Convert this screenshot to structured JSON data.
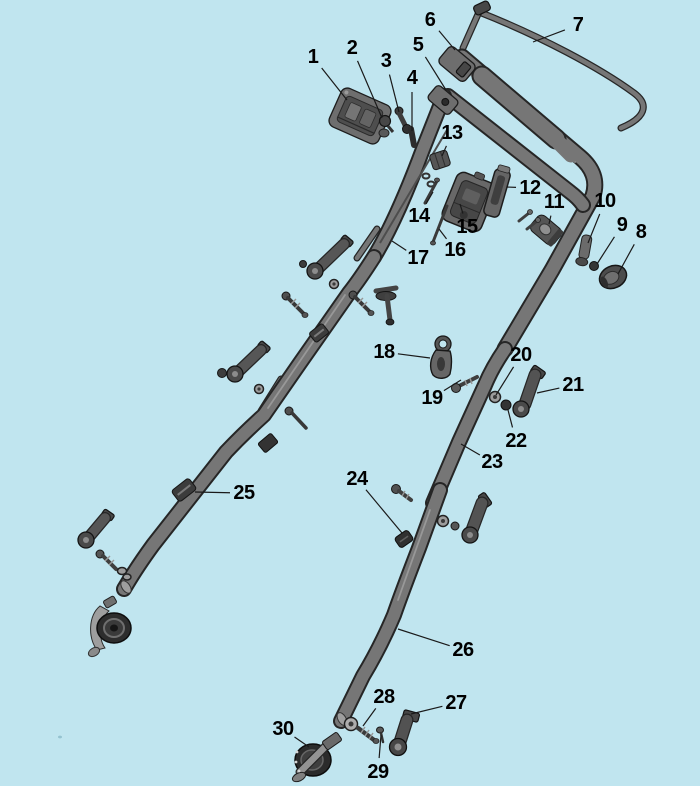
{
  "diagram": {
    "type": "exploded-parts-diagram",
    "subject": "mower-handle-assembly",
    "background_color": "#c0e5ef",
    "palette": {
      "part_dark": "#474747",
      "part_mid": "#6e6e6e",
      "part_light": "#b3b3b3",
      "outline": "#262626",
      "label_color": "#000000",
      "leader_color": "#1a1a1a"
    },
    "callouts": [
      {
        "number": "1",
        "label_x": 313,
        "label_y": 57,
        "target_x": 347,
        "target_y": 100
      },
      {
        "number": "2",
        "label_x": 352,
        "label_y": 48,
        "target_x": 382,
        "target_y": 118
      },
      {
        "number": "3",
        "label_x": 386,
        "label_y": 61,
        "target_x": 399,
        "target_y": 112
      },
      {
        "number": "4",
        "label_x": 412,
        "label_y": 78,
        "target_x": 412,
        "target_y": 131
      },
      {
        "number": "5",
        "label_x": 418,
        "label_y": 45,
        "target_x": 446,
        "target_y": 90
      },
      {
        "number": "6",
        "label_x": 430,
        "label_y": 20,
        "target_x": 455,
        "target_y": 50
      },
      {
        "number": "7",
        "label_x": 578,
        "label_y": 25,
        "target_x": 533,
        "target_y": 42
      },
      {
        "number": "8",
        "label_x": 641,
        "label_y": 232,
        "target_x": 618,
        "target_y": 274
      },
      {
        "number": "9",
        "label_x": 622,
        "label_y": 225,
        "target_x": 597,
        "target_y": 264
      },
      {
        "number": "10",
        "label_x": 605,
        "label_y": 201,
        "target_x": 588,
        "target_y": 243
      },
      {
        "number": "11",
        "label_x": 554,
        "label_y": 202,
        "target_x": 549,
        "target_y": 224
      },
      {
        "number": "12",
        "label_x": 530,
        "label_y": 188,
        "target_x": 507,
        "target_y": 187
      },
      {
        "number": "13",
        "label_x": 452,
        "label_y": 133,
        "target_x": 442,
        "target_y": 156
      },
      {
        "number": "14",
        "label_x": 419,
        "label_y": 216,
        "target_x": 433,
        "target_y": 192
      },
      {
        "number": "15",
        "label_x": 467,
        "label_y": 227,
        "target_x": 460,
        "target_y": 204
      },
      {
        "number": "16",
        "label_x": 455,
        "label_y": 250,
        "target_x": 439,
        "target_y": 229
      },
      {
        "number": "17",
        "label_x": 418,
        "label_y": 258,
        "target_x": 392,
        "target_y": 241
      },
      {
        "number": "18",
        "label_x": 384,
        "label_y": 352,
        "target_x": 430,
        "target_y": 358
      },
      {
        "number": "19",
        "label_x": 432,
        "label_y": 398,
        "target_x": 461,
        "target_y": 380
      },
      {
        "number": "20",
        "label_x": 521,
        "label_y": 355,
        "target_x": 496,
        "target_y": 395
      },
      {
        "number": "21",
        "label_x": 573,
        "label_y": 385,
        "target_x": 537,
        "target_y": 393
      },
      {
        "number": "22",
        "label_x": 516,
        "label_y": 441,
        "target_x": 508,
        "target_y": 410
      },
      {
        "number": "23",
        "label_x": 492,
        "label_y": 462,
        "target_x": 461,
        "target_y": 444
      },
      {
        "number": "24",
        "label_x": 357,
        "label_y": 479,
        "target_x": 402,
        "target_y": 533
      },
      {
        "number": "25",
        "label_x": 244,
        "label_y": 493,
        "target_x": 195,
        "target_y": 492
      },
      {
        "number": "26",
        "label_x": 463,
        "label_y": 650,
        "target_x": 398,
        "target_y": 629
      },
      {
        "number": "27",
        "label_x": 456,
        "label_y": 703,
        "target_x": 411,
        "target_y": 714
      },
      {
        "number": "28",
        "label_x": 384,
        "label_y": 697,
        "target_x": 363,
        "target_y": 726
      },
      {
        "number": "29",
        "label_x": 378,
        "label_y": 772,
        "target_x": 381,
        "target_y": 735
      },
      {
        "number": "30",
        "label_x": 283,
        "label_y": 729,
        "target_x": 309,
        "target_y": 747
      }
    ]
  }
}
